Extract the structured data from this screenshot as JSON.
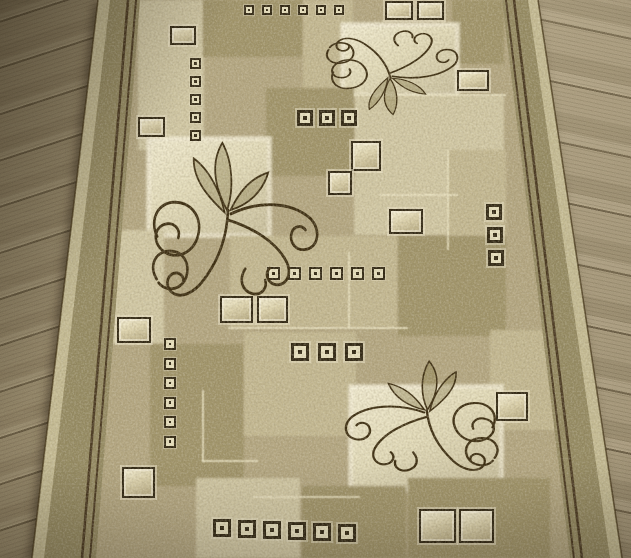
{
  "image": {
    "width": 631,
    "height": 558
  },
  "scene": {
    "type": "photograph",
    "subject": "Beige runner rug with geometric square patchwork and dark floral scroll ornaments, lying diagonally on a grey-brown wooden plank floor",
    "floor": {
      "material": "wood planks",
      "tone": "grey-brown",
      "plank_direction": "horizontal with perspective tilt"
    },
    "rug": {
      "style": "modern geometric patchwork with scroll flourishes",
      "border": "plain speckled band with double dark pinstripe on left and right sides",
      "ornament_count": 3,
      "cut_off": "top and bottom edges run out of frame"
    }
  },
  "palette": {
    "wood_base": "#968768",
    "wood_light": "#ab9b7c",
    "wood_dark": "#7e7054",
    "field_base": "#b0a27c",
    "light1": "#d0c6a1",
    "cream_bg": "#e3dbb8",
    "mid": "#c1b58d",
    "khaki": "#9b8e65",
    "border_band": "#8f845e",
    "edge_light": "#cdc299",
    "pinstripe": "#44341e",
    "scroll_dark": "#37290f",
    "square_dark": "#2b2210",
    "square_fill": "#eae2c0"
  },
  "rug_elements": {
    "patches": [
      {
        "x": 138,
        "y": 0,
        "w": 66,
        "h": 150,
        "shade": "light1"
      },
      {
        "x": 203,
        "y": 0,
        "w": 100,
        "h": 57,
        "shade": "khaki"
      },
      {
        "x": 303,
        "y": 0,
        "w": 50,
        "h": 96,
        "shade": "mid"
      },
      {
        "x": 452,
        "y": 0,
        "w": 52,
        "h": 64,
        "shade": "khaki"
      },
      {
        "x": 342,
        "y": 24,
        "w": 116,
        "h": 72,
        "shade": "cream_bg",
        "outlined": true
      },
      {
        "x": 354,
        "y": 95,
        "w": 150,
        "h": 140,
        "shade": "light1"
      },
      {
        "x": 448,
        "y": 150,
        "w": 58,
        "h": 86,
        "shade": "mid"
      },
      {
        "x": 266,
        "y": 88,
        "w": 88,
        "h": 88,
        "shade": "khaki"
      },
      {
        "x": 148,
        "y": 138,
        "w": 122,
        "h": 98,
        "shade": "cream_bg",
        "outlined": true
      },
      {
        "x": 96,
        "y": 230,
        "w": 68,
        "h": 114,
        "shade": "light1"
      },
      {
        "x": 230,
        "y": 236,
        "w": 168,
        "h": 92,
        "shade": "mid"
      },
      {
        "x": 398,
        "y": 236,
        "w": 108,
        "h": 100,
        "shade": "khaki"
      },
      {
        "x": 490,
        "y": 330,
        "w": 76,
        "h": 100,
        "shade": "mid"
      },
      {
        "x": 150,
        "y": 344,
        "w": 94,
        "h": 142,
        "shade": "khaki"
      },
      {
        "x": 244,
        "y": 332,
        "w": 112,
        "h": 104,
        "shade": "mid"
      },
      {
        "x": 350,
        "y": 386,
        "w": 152,
        "h": 104,
        "shade": "cream_bg",
        "outlined": true
      },
      {
        "x": 196,
        "y": 478,
        "w": 104,
        "h": 80,
        "shade": "light1"
      },
      {
        "x": 302,
        "y": 486,
        "w": 104,
        "h": 72,
        "shade": "khaki"
      },
      {
        "x": 408,
        "y": 478,
        "w": 142,
        "h": 80,
        "shade": "khaki"
      }
    ],
    "accent_lines": [
      {
        "x": 354,
        "y": 94,
        "w": 152,
        "h": 2
      },
      {
        "x": 447,
        "y": 150,
        "w": 2,
        "h": 100
      },
      {
        "x": 380,
        "y": 194,
        "w": 78,
        "h": 2
      },
      {
        "x": 348,
        "y": 252,
        "w": 2,
        "h": 76
      },
      {
        "x": 228,
        "y": 327,
        "w": 180,
        "h": 2
      },
      {
        "x": 202,
        "y": 390,
        "w": 2,
        "h": 72
      },
      {
        "x": 202,
        "y": 460,
        "w": 56,
        "h": 2
      },
      {
        "x": 252,
        "y": 496,
        "w": 108,
        "h": 2
      }
    ],
    "stud_groups": [
      {
        "x": 244,
        "y": 5,
        "size": 10,
        "count": 6,
        "dx": 18,
        "dy": 0
      },
      {
        "x": 190,
        "y": 58,
        "size": 11,
        "count": 5,
        "dx": 0,
        "dy": 18
      },
      {
        "x": 297,
        "y": 110,
        "size": 16,
        "count": 3,
        "dx": 22,
        "dy": 0
      },
      {
        "x": 267,
        "y": 267,
        "size": 13,
        "count": 6,
        "dx": 21,
        "dy": 0
      },
      {
        "x": 291,
        "y": 343,
        "size": 18,
        "count": 3,
        "dx": 27,
        "dy": 0
      },
      {
        "x": 164,
        "y": 338,
        "size": 12,
        "count": 6,
        "dx": 0,
        "dy": 19.5
      },
      {
        "x": 213,
        "y": 519,
        "size": 18,
        "count": 6,
        "dx": 25,
        "dy": 1
      },
      {
        "x": 486,
        "y": 204,
        "size": 16,
        "count": 3,
        "dx": 1,
        "dy": 23
      }
    ],
    "tiles": [
      {
        "x": 170,
        "y": 26,
        "w": 26,
        "h": 19
      },
      {
        "x": 385,
        "y": 1,
        "w": 28,
        "h": 19
      },
      {
        "x": 417,
        "y": 1,
        "w": 27,
        "h": 19
      },
      {
        "x": 457,
        "y": 70,
        "w": 32,
        "h": 21
      },
      {
        "x": 138,
        "y": 117,
        "w": 27,
        "h": 20
      },
      {
        "x": 351,
        "y": 141,
        "w": 30,
        "h": 30
      },
      {
        "x": 328,
        "y": 171,
        "w": 24,
        "h": 24
      },
      {
        "x": 389,
        "y": 209,
        "w": 34,
        "h": 25
      },
      {
        "x": 220,
        "y": 296,
        "w": 33,
        "h": 27
      },
      {
        "x": 257,
        "y": 296,
        "w": 31,
        "h": 27
      },
      {
        "x": 117,
        "y": 317,
        "w": 34,
        "h": 26
      },
      {
        "x": 496,
        "y": 392,
        "w": 32,
        "h": 29
      },
      {
        "x": 122,
        "y": 467,
        "w": 33,
        "h": 31
      },
      {
        "x": 419,
        "y": 509,
        "w": 37,
        "h": 34
      },
      {
        "x": 459,
        "y": 509,
        "w": 35,
        "h": 34
      }
    ],
    "flourishes": [
      {
        "x": 144,
        "y": 138,
        "w": 192,
        "h": 164,
        "flip": "none",
        "rot": -4
      },
      {
        "x": 324,
        "y": 28,
        "w": 150,
        "h": 88,
        "flip": "v",
        "rot": -5
      },
      {
        "x": 328,
        "y": 358,
        "w": 176,
        "h": 118,
        "flip": "h",
        "rot": 2
      }
    ]
  }
}
